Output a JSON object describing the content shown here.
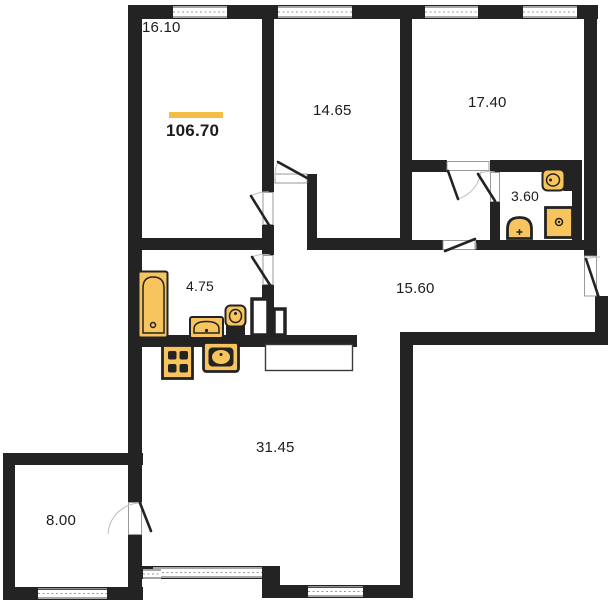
{
  "floor_plan": {
    "type": "apartment-floor-plan",
    "total_area": {
      "label": "106.70"
    },
    "rooms": {
      "top_left_room": {
        "area": "16.10"
      },
      "top_middle_room": {
        "area": "14.65"
      },
      "top_right_room": {
        "area": "17.40"
      },
      "small_bathroom": {
        "area": "3.60"
      },
      "bathroom": {
        "area": "4.75"
      },
      "hallway": {
        "area": "15.60"
      },
      "living_kitchen": {
        "area": "31.45"
      },
      "balcony": {
        "area": "8.00"
      }
    },
    "fixtures": [
      "bathtub",
      "sink",
      "toilet",
      "stove",
      "kitchen-sink",
      "washing-machine",
      "toilet-horizontal",
      "small-sink"
    ],
    "colors": {
      "wall": "#232323",
      "fixture_fill": "#F7C45E",
      "accent_bar": "#F2BE45",
      "label_text": "#1C1C1C",
      "background": "#FFFFFF"
    }
  }
}
